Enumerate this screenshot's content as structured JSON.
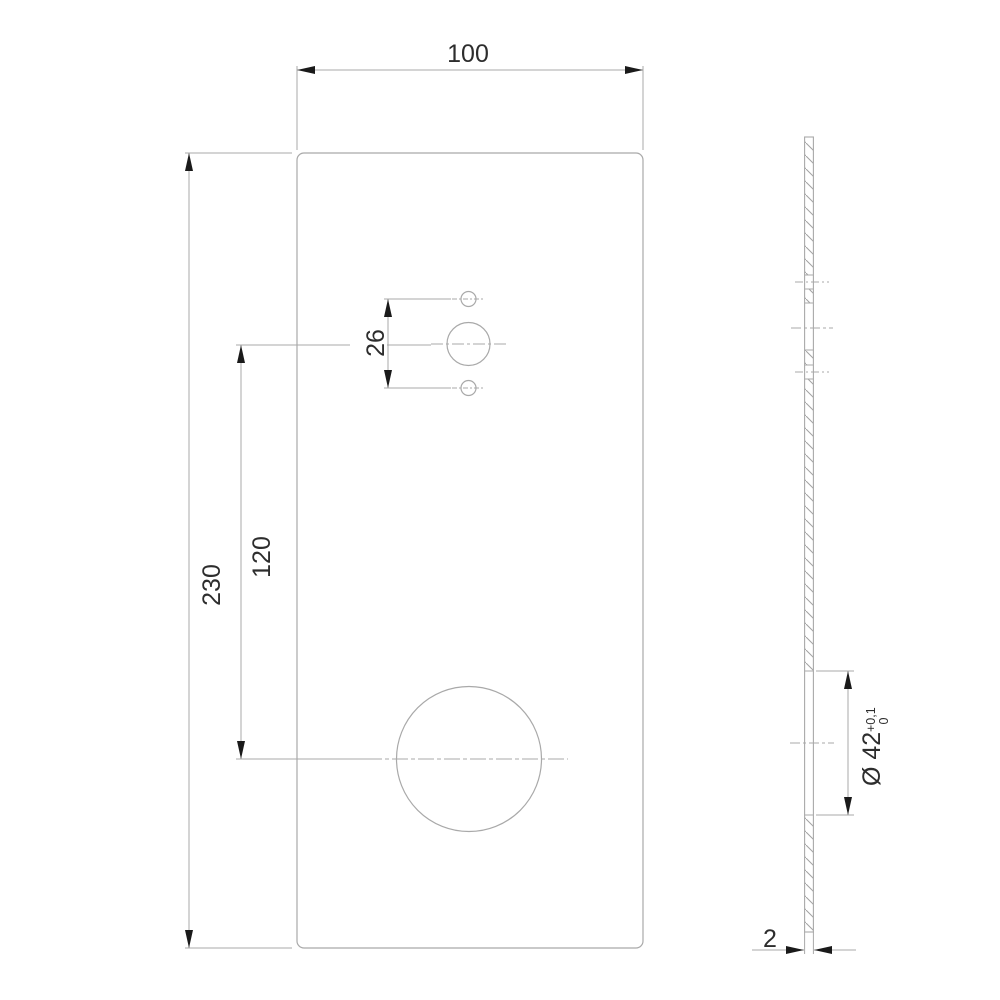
{
  "colors": {
    "line": "#a9a9a9",
    "hatch": "#a2a2a2",
    "text": "#2d2d2d",
    "arrow": "#1a1a1a",
    "background": "#ffffff"
  },
  "views": {
    "front_view": "front view of rectangular plate with four holes",
    "side_view": "sectioned side view of 2 mm plate with hatching"
  },
  "dimensions": {
    "plate_width": "100",
    "plate_height": "230",
    "hole_center_distance": "120",
    "small_hole_spacing": "26",
    "large_hole_diameter": "Ø 42",
    "large_hole_tol_upper": "+0,1",
    "large_hole_tol_lower": "0",
    "plate_thickness": "2"
  }
}
